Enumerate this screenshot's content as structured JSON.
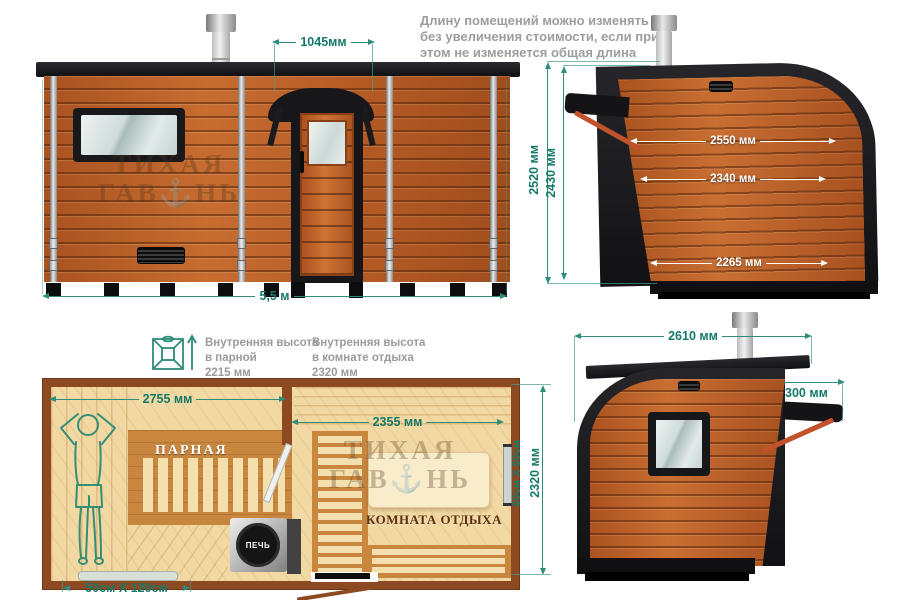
{
  "top_note": {
    "line1": "Длину помещений можно изменять",
    "line2": "без увеличения стоимости, если при",
    "line3": "этом не изменяется общая длина",
    "line4": "бани."
  },
  "watermark": {
    "line1": "ТИХАЯ",
    "line2": "ГАВ⚓НЬ"
  },
  "front_view": {
    "door_width": "1045мм",
    "total_length": "5,5 м"
  },
  "side_view": {
    "height_outer": "2520 мм",
    "height_inner": "2430 мм",
    "width_top": "2550 мм",
    "width_mid": "2340 мм",
    "width_base": "2265 мм"
  },
  "height_notes": {
    "parnaya": {
      "line1": "Внутренняя высота",
      "line2": "в парной",
      "line3": "2215 мм"
    },
    "rest": {
      "line1": "Внутренняя высота",
      "line2": "в комнате отдыха",
      "line3": "2320 мм"
    }
  },
  "floor_plan": {
    "parnaya_label": "ПАРНАЯ",
    "rest_label": "КОМНАТА ОТДЫХА",
    "stove_label": "ПЕЧЬ",
    "parnaya_width": "2755 мм",
    "rest_width": "2355 мм",
    "plan_depth": "2320 мм",
    "window_size": "60см X 60см",
    "step_size": "50см X 120см"
  },
  "rear_view": {
    "total_width": "2610 мм",
    "awning_depth": "300 мм"
  },
  "colors": {
    "dimension": "#15796a",
    "wood": "#b55c26",
    "plan_wall": "#8d4a22",
    "strut": "#c1522b"
  }
}
